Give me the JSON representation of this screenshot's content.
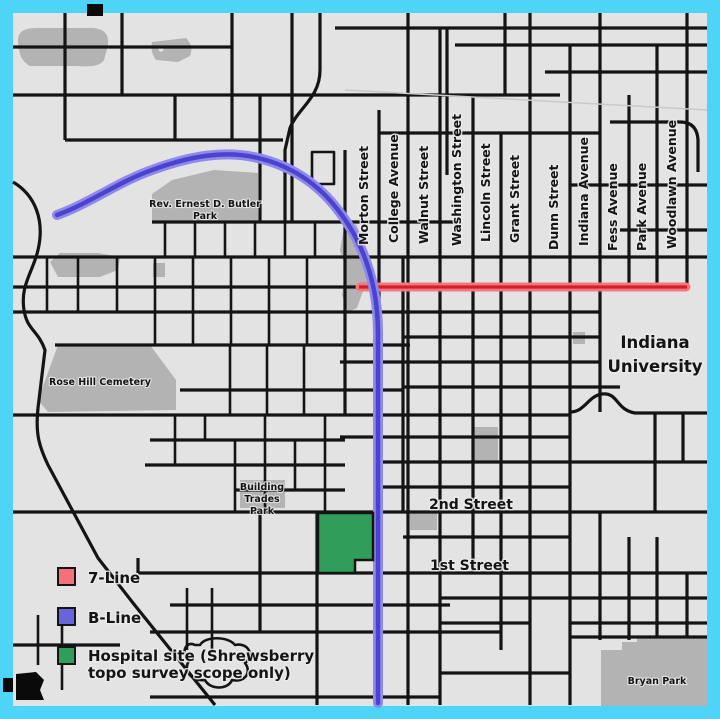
{
  "title": "Bloomington street map — 7-Line, B-Line and hospital site",
  "frame_color": "#4ed4f7",
  "map": {
    "background_color": "#e3e3e3",
    "street_color": "#141414",
    "park_color": "#b3b3b3",
    "street_labels": [
      "Morton Street",
      "College Avenue",
      "Walnut Street",
      "Washington Street",
      "Lincoln Street",
      "Grant Street",
      "Dunn Street",
      "Indiana Avenue",
      "Fess Avenue",
      "Park Avenue",
      "Woodlawn Avenue"
    ],
    "cross_streets": {
      "second_street": "2nd Street",
      "first_street": "1st Street"
    },
    "places": {
      "butler_park_line1": "Rev. Ernest D. Butler",
      "butler_park_line2": "Park",
      "rose_hill_cemetery": "Rose Hill Cemetery",
      "building_trades_line1": "Building",
      "building_trades_line2": "Trades",
      "building_trades_line3": "Park",
      "indiana_university_line1": "Indiana",
      "indiana_university_line2": "University",
      "bryan_park": "Bryan Park"
    }
  },
  "lines": {
    "seven_line": {
      "halo": "#f4767e",
      "core": "#cf2129"
    },
    "b_line": {
      "halo": "#8f89ea",
      "core": "#4b43cf"
    }
  },
  "legend": {
    "items": [
      {
        "id": "7-line",
        "label": "7-Line",
        "color": "#f4717b"
      },
      {
        "id": "b-line",
        "label": "B-Line",
        "color": "#6a63de"
      },
      {
        "id": "hospital-site",
        "label": "Hospital site (Shrewsberry topo survey scope only)",
        "label_line1": "Hospital site (Shrewsberry",
        "label_line2": "topo survey scope only)",
        "color": "#2f9e5b"
      }
    ]
  }
}
